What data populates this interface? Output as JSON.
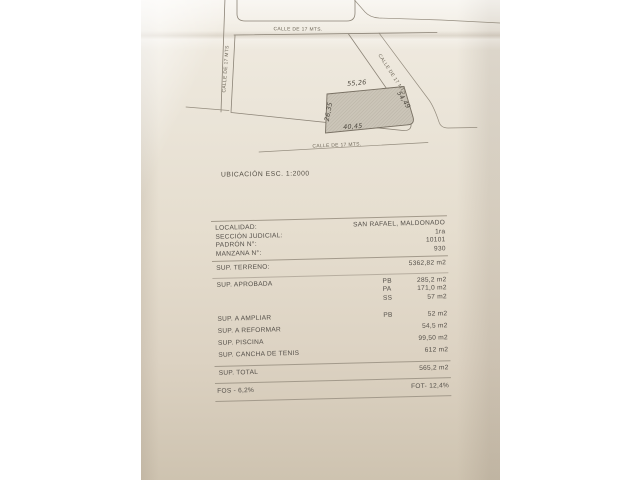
{
  "map": {
    "caption": "UBICACIÓN ESC. 1:2000",
    "streets": {
      "top": "CALLE DE 17 MTS.",
      "left": "CALLE DE 17 MTS",
      "diagonal": "CALLE DE 17 MTS",
      "bottom": "CALLE DE 17 MTS."
    },
    "plot_dimensions": {
      "top": "55,26",
      "left": "26,35",
      "bottom": "40,45",
      "right": "54,49"
    }
  },
  "table": {
    "info_rows": [
      {
        "label": "LOCALIDAD:",
        "value": "SAN RAFAEL, MALDONADO"
      },
      {
        "label": "SECCIÓN JUDICIAL:",
        "value": "1ra"
      },
      {
        "label": "PADRÓN N°:",
        "value": "10101"
      },
      {
        "label": "MANZANA N°:",
        "value": "930"
      }
    ],
    "terreno": {
      "label": "SUP. TERRENO:",
      "value": "5362,82 m2"
    },
    "aprobada": {
      "label": "SUP. APROBADA",
      "rows": [
        {
          "code": "PB",
          "value": "285,2 m2"
        },
        {
          "code": "PA",
          "value": "171,0 m2"
        },
        {
          "code": "SS",
          "value": "57 m2"
        }
      ]
    },
    "ampliar": {
      "label": "SUP. A AMPLIAR",
      "code": "PB",
      "value": "52 m2"
    },
    "reformar": {
      "label": "SUP. A REFORMAR",
      "value": "54,5 m2"
    },
    "piscina": {
      "label": "SUP. PISCINA",
      "value": "99,50 m2"
    },
    "cancha": {
      "label": "SUP. CANCHA DE TENIS",
      "value": "612 m2"
    },
    "total": {
      "label": "SUP. TOTAL",
      "value": "565,2 m2"
    },
    "fos": "FOS - 6,2%",
    "fot": "FOT- 12,4%"
  }
}
